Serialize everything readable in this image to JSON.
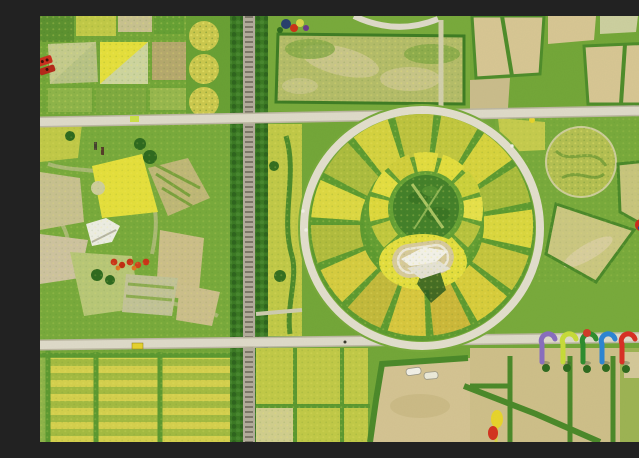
{
  "meta": {
    "description": "Aerial drone photograph of a flower theme park: a large circular parterre garden of yellow and green flower wedges with a white monument at its center, surrounded by rectangular crop fields, a tree-lined railway, crossing white roads and colorful art installations.",
    "alt": "Top-down aerial view of flower fields with a circular garden, roads, railway and sculptures"
  },
  "palette": {
    "grass": "#74a739",
    "grass2": "#79ab3c",
    "grassDark": "#4c8a2a",
    "grassDeep": "#2f6b1f",
    "treeLine": "#3c7a24",
    "yellowBright": "#e6e03c",
    "yellowField": "#d6d14e",
    "yellowGreen": "#c2ca48",
    "oliveStripe": "#a4bb42",
    "paleBed": "#c9c290",
    "tan": "#d8c794",
    "tanSoft": "#cfc08a",
    "road": "#dfdbca",
    "roadEdge": "#bdb8a3",
    "rail": "#b3ac9c",
    "white": "#f2f0e8",
    "red": "#cc2f1f",
    "blue": "#2e86d4",
    "violet": "#8a6fc0",
    "limeArch": "#c8dc3a",
    "greenArch": "#2f8e2f",
    "dotNavy": "#2b4a8c",
    "monumentPad": "#d8cb9c",
    "shadow": "#2c5c20",
    "blockMottle": "#b5bd6a"
  },
  "garden_circle": {
    "outer_segment_colors": [
      "#c3c83f",
      "#d8d43e",
      "#aabd3d",
      "#dcd83f",
      "#c6c63e",
      "#d9ce3c",
      "#cdb93a",
      "#d9c83e",
      "#c4ba3c",
      "#d7cd40",
      "#b2bd3e",
      "#ded943",
      "#adbd3f",
      "#d6d340",
      "#bec43f"
    ],
    "inner_segment_colors": [
      "#e4de3e",
      "#cdd23c",
      "#e7e14a",
      "#b9c43e",
      "#e2dc3e",
      "#d5d23c",
      "#e6e045",
      "#c2c93e",
      "#dfd93c",
      "#e5df42",
      "#d2cf3c",
      "#e3dd40"
    ],
    "spoke_color": "#5f9c31",
    "ring_path_color": "#e3dfce",
    "inner_circle_color": "#45822a",
    "monument_pad_color": "#d8cb9c",
    "sculpture_color": "#f4f2ea",
    "shadow_color": "#2c5c20",
    "surround_flower_color": "#e5df3e"
  },
  "installations": {
    "rainbow_arch_colors": [
      "#8a6fc0",
      "#c8dc3a",
      "#2f8e2f",
      "#2e86d4",
      "#d93025"
    ],
    "arch_cap_color": "#d23c28",
    "caterpillar_body_color": "#cc2d1e",
    "caterpillar_spot_color": "#2b4a8c",
    "caterpillar_head_color": "#3f8f2e",
    "pinwheel_color": "#d02c1c",
    "train_color": "#c62f1d",
    "flower_sculpture_colors": [
      "#e8d52c",
      "#d43420"
    ],
    "car_colors": [
      "#f4f2ea",
      "#e6d32e",
      "#cde04a"
    ]
  }
}
